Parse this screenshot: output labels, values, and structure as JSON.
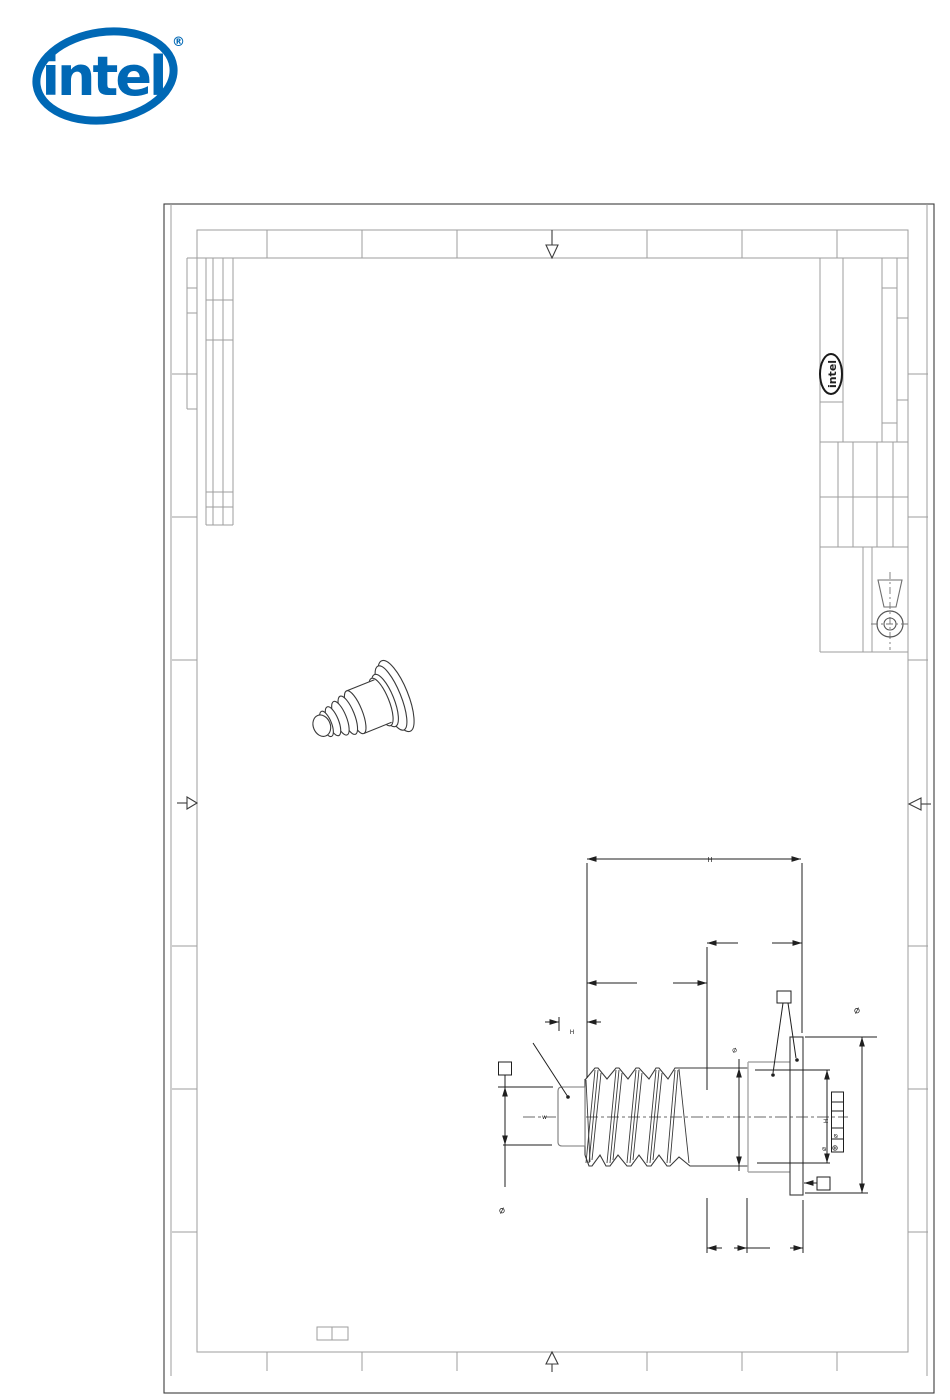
{
  "colors": {
    "intel_blue": "#0068B5",
    "frame_dark": "#3c3c3c",
    "frame_gray": "#9e9e9e",
    "part_dark": "#3a3a3a",
    "part_gray": "#a8a8a8",
    "dim": "#1f1f1f"
  },
  "logo": {
    "brand": "intel",
    "registered": "®"
  },
  "title_block": {
    "brand": "intel"
  },
  "annotations": {
    "overall_length": "H",
    "tip_length": "H",
    "tip_diameter": "⌀",
    "shank_diameter": "⌀",
    "flange_diameter": "⌀",
    "head_diameter_symbol": "⌀",
    "head_diameter_value": "H",
    "fcf_diameter": "⌀",
    "fcf_position": "⊕",
    "center_note": "w"
  }
}
